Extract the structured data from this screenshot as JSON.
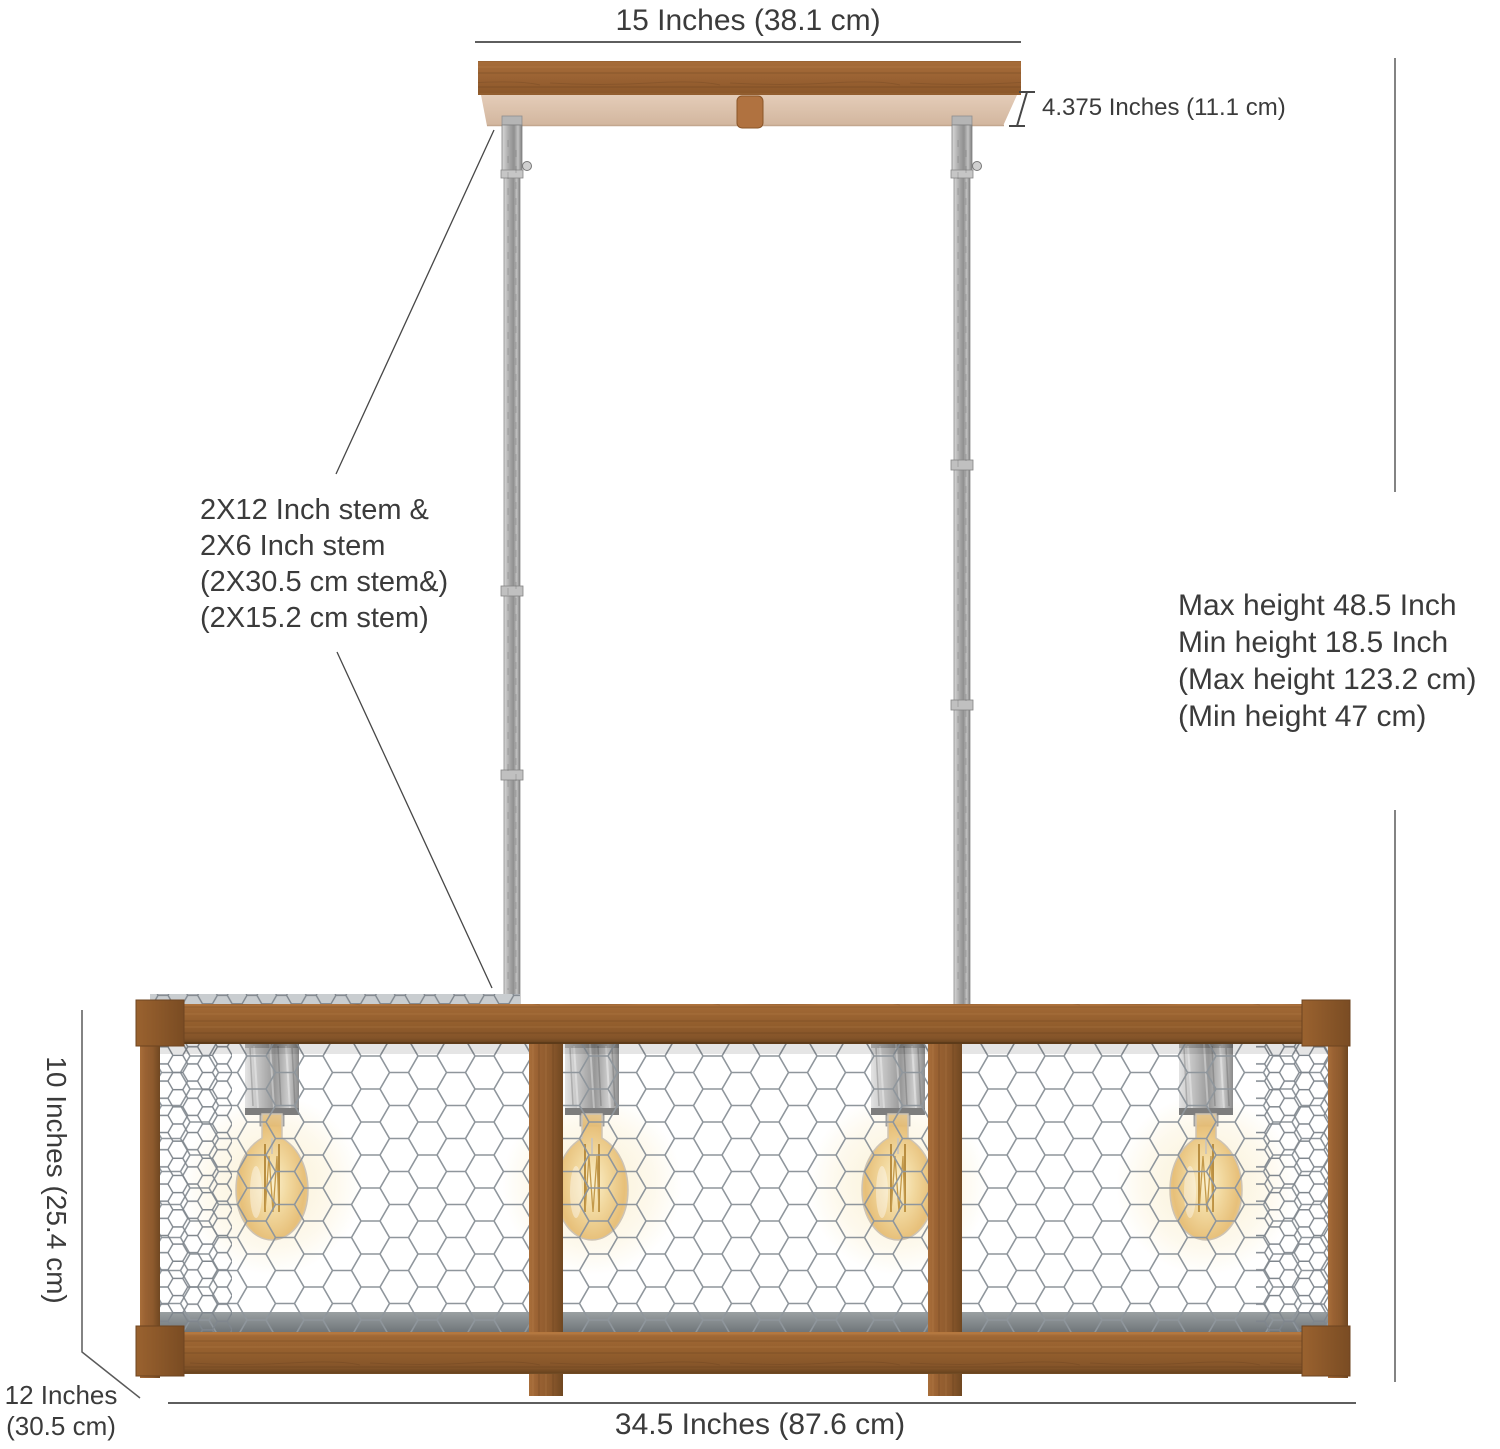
{
  "colors": {
    "wood": "#96602F",
    "wood_underside": "#DCC3AE",
    "metal_silver": "#B5B8BA",
    "bulb_glow": "#ECCA85",
    "dimension_line": "#474747",
    "text": "#3B3B3B",
    "background": "#FFFFFF"
  },
  "labels": {
    "canopy_width": "15 Inches (38.1 cm)",
    "canopy_height": "4.375 Inches (11.1 cm)",
    "stem_note": [
      "2X12 Inch stem &",
      "2X6 Inch stem",
      "(2X30.5 cm stem&)",
      "(2X15.2 cm stem)"
    ],
    "height_note": [
      "Max height 48.5 Inch",
      "Min height 18.5 Inch",
      "(Max height 123.2 cm)",
      "(Min height 47 cm)"
    ],
    "cage_height": "10 Inches (25.4 cm)",
    "cage_depth": [
      "12 Inches",
      "(30.5 cm)"
    ],
    "cage_width": "34.5 Inches (87.6 cm)"
  }
}
